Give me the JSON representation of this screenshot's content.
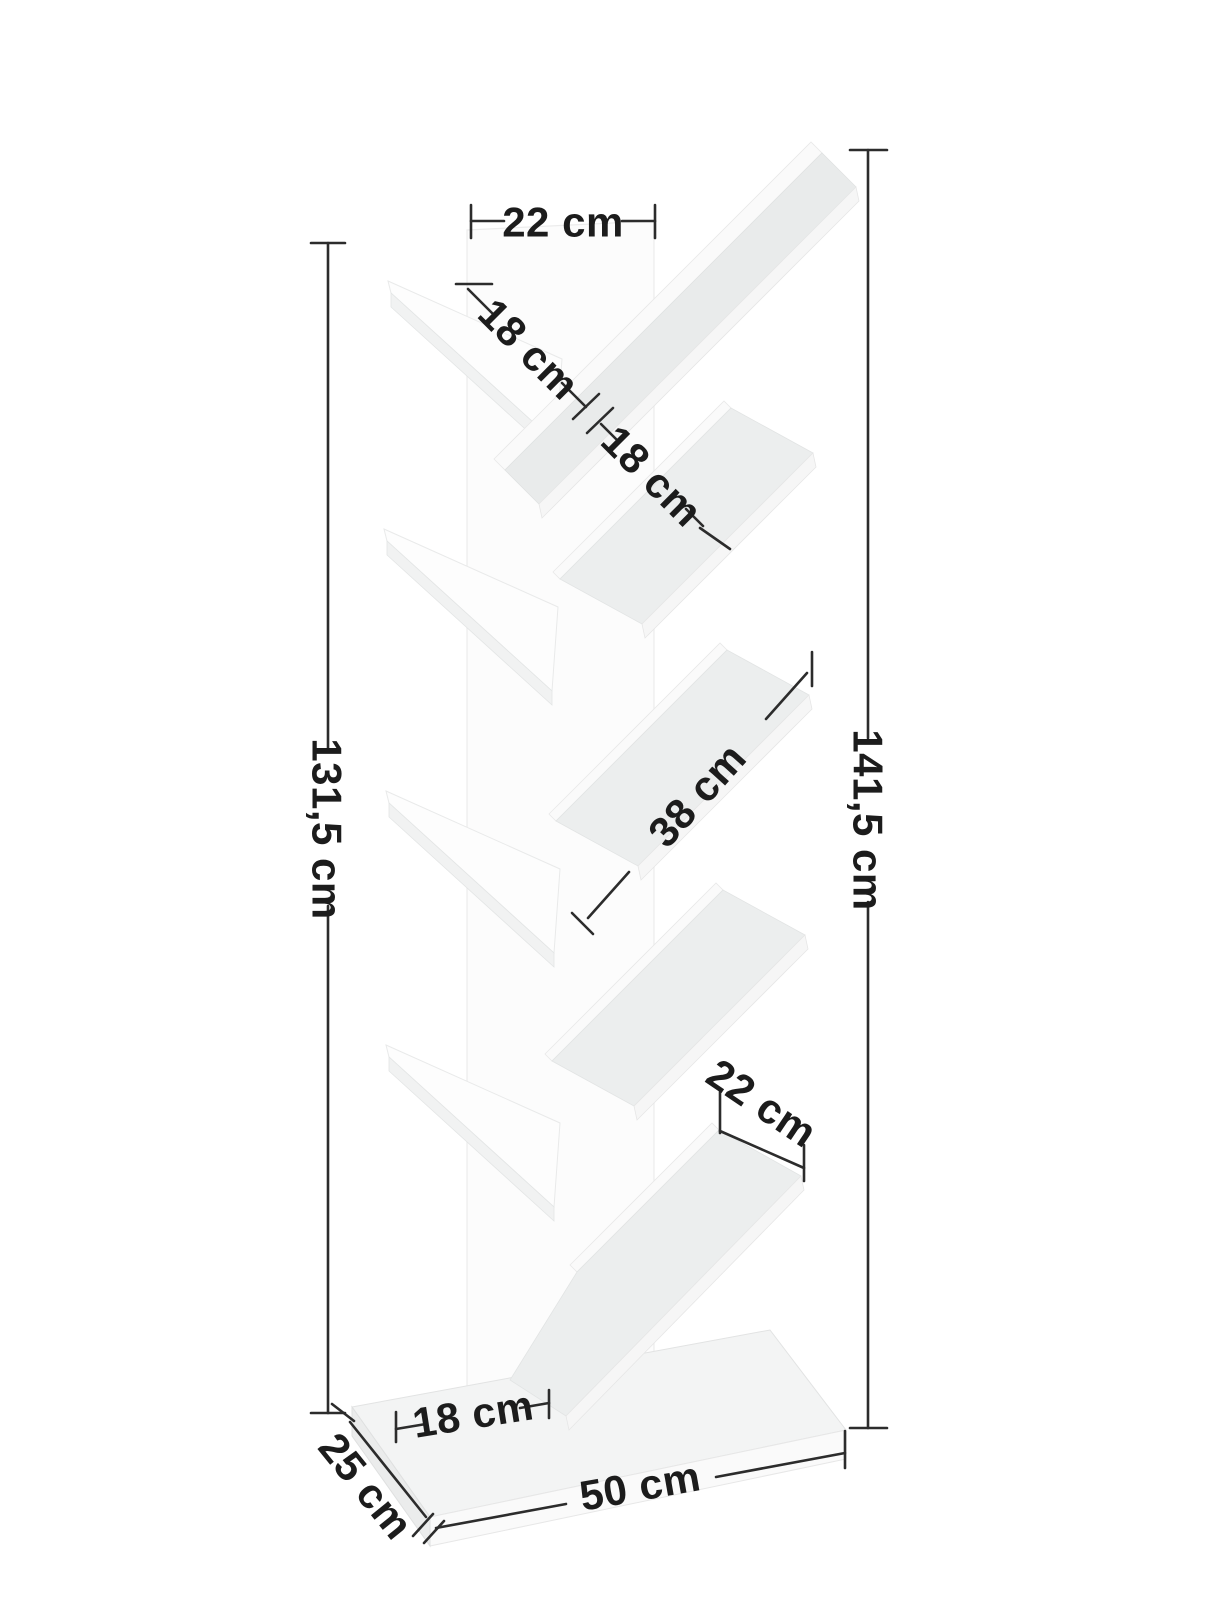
{
  "page": {
    "background_color": "#ffffff"
  },
  "diagram": {
    "subject": "tree-shaped bookshelf with nine slanted shelves on a rectangular base",
    "view": "three-quarter product dimension illustration",
    "colors": {
      "furniture_white": "#ffffff",
      "furniture_shade_light": "#ececec",
      "furniture_shade_mid": "#e0e2e2",
      "dimension_line": "#2c2c2c",
      "label_text": "#1c1c1c"
    },
    "labels": {
      "top_shelf_width": "22 cm",
      "upper_left_shelf_gap": "18 cm",
      "upper_right_shelf_gap": "18 cm",
      "middle_shelf_length": "38 cm",
      "lower_right_shelf_width": "22 cm",
      "spine_height": "131,5 cm",
      "total_height": "141,5 cm",
      "base_front_inset": "18 cm",
      "base_depth": "25 cm",
      "base_width": "50 cm"
    }
  }
}
